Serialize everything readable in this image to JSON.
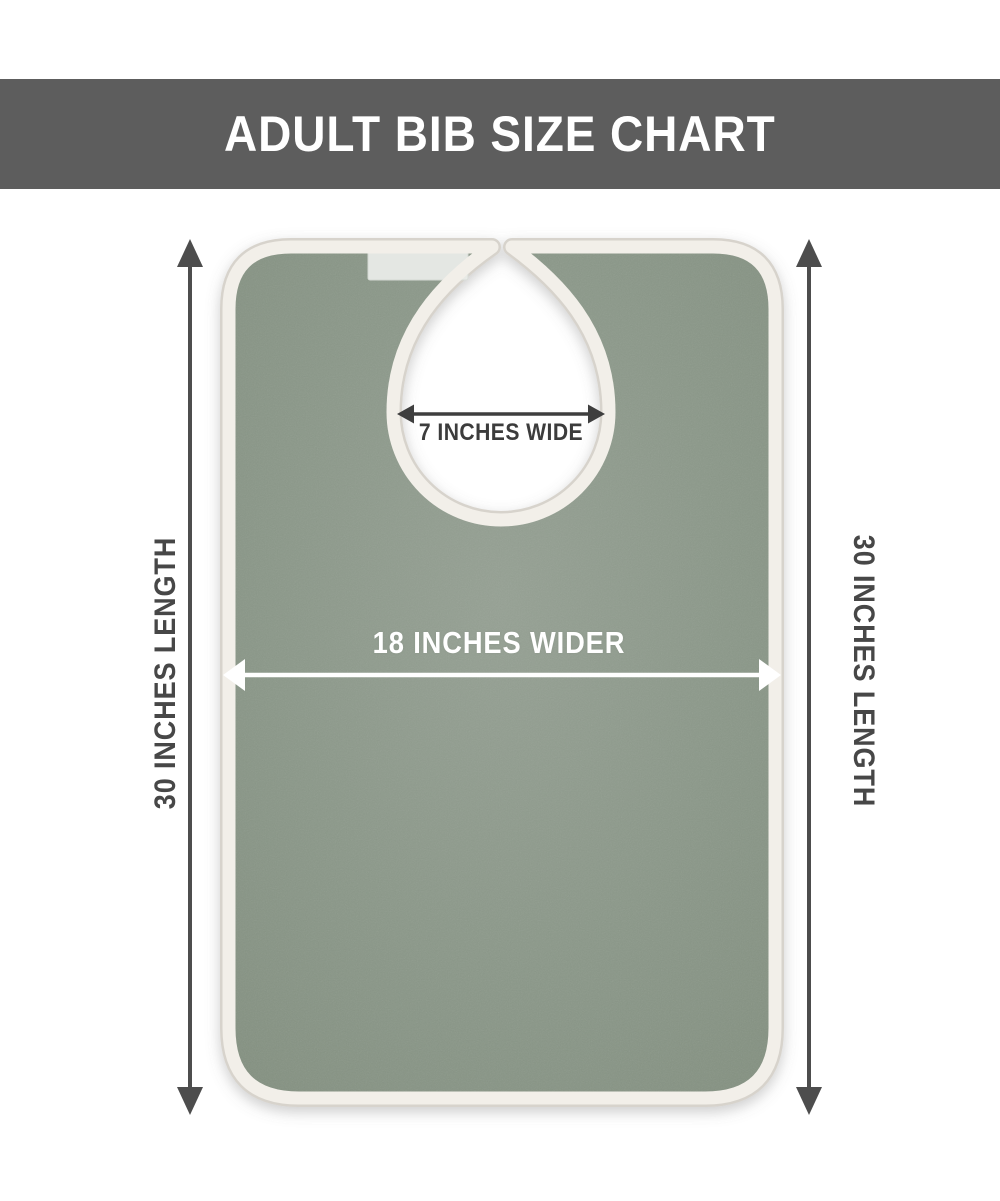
{
  "header": {
    "title": "ADULT BIB SIZE CHART"
  },
  "labels": {
    "left_length": "30 INCHES LENGTH",
    "right_length": "30 INCHES LENGTH",
    "width": "18 INCHES WIDER",
    "neck_width": "7 INCHES WIDE"
  },
  "dimensions": {
    "length_inches": 30,
    "width_inches": 18,
    "neck_width_inches": 7
  },
  "colors": {
    "banner_bg": "#5d5d5d",
    "banner_text": "#ffffff",
    "bib_body": "#8b9889",
    "bib_trim": "#f2efe9",
    "trim_shadow": "#d7d3cc",
    "velcro": "#e9ece8",
    "dark_arrow": "#4d4d4d",
    "neck_arrow": "#3e3e3e",
    "white_arrow": "#ffffff",
    "background": "#ffffff"
  },
  "icons": {
    "vertical_double_arrow": "dimension arrow",
    "horizontal_double_arrow": "dimension arrow"
  }
}
